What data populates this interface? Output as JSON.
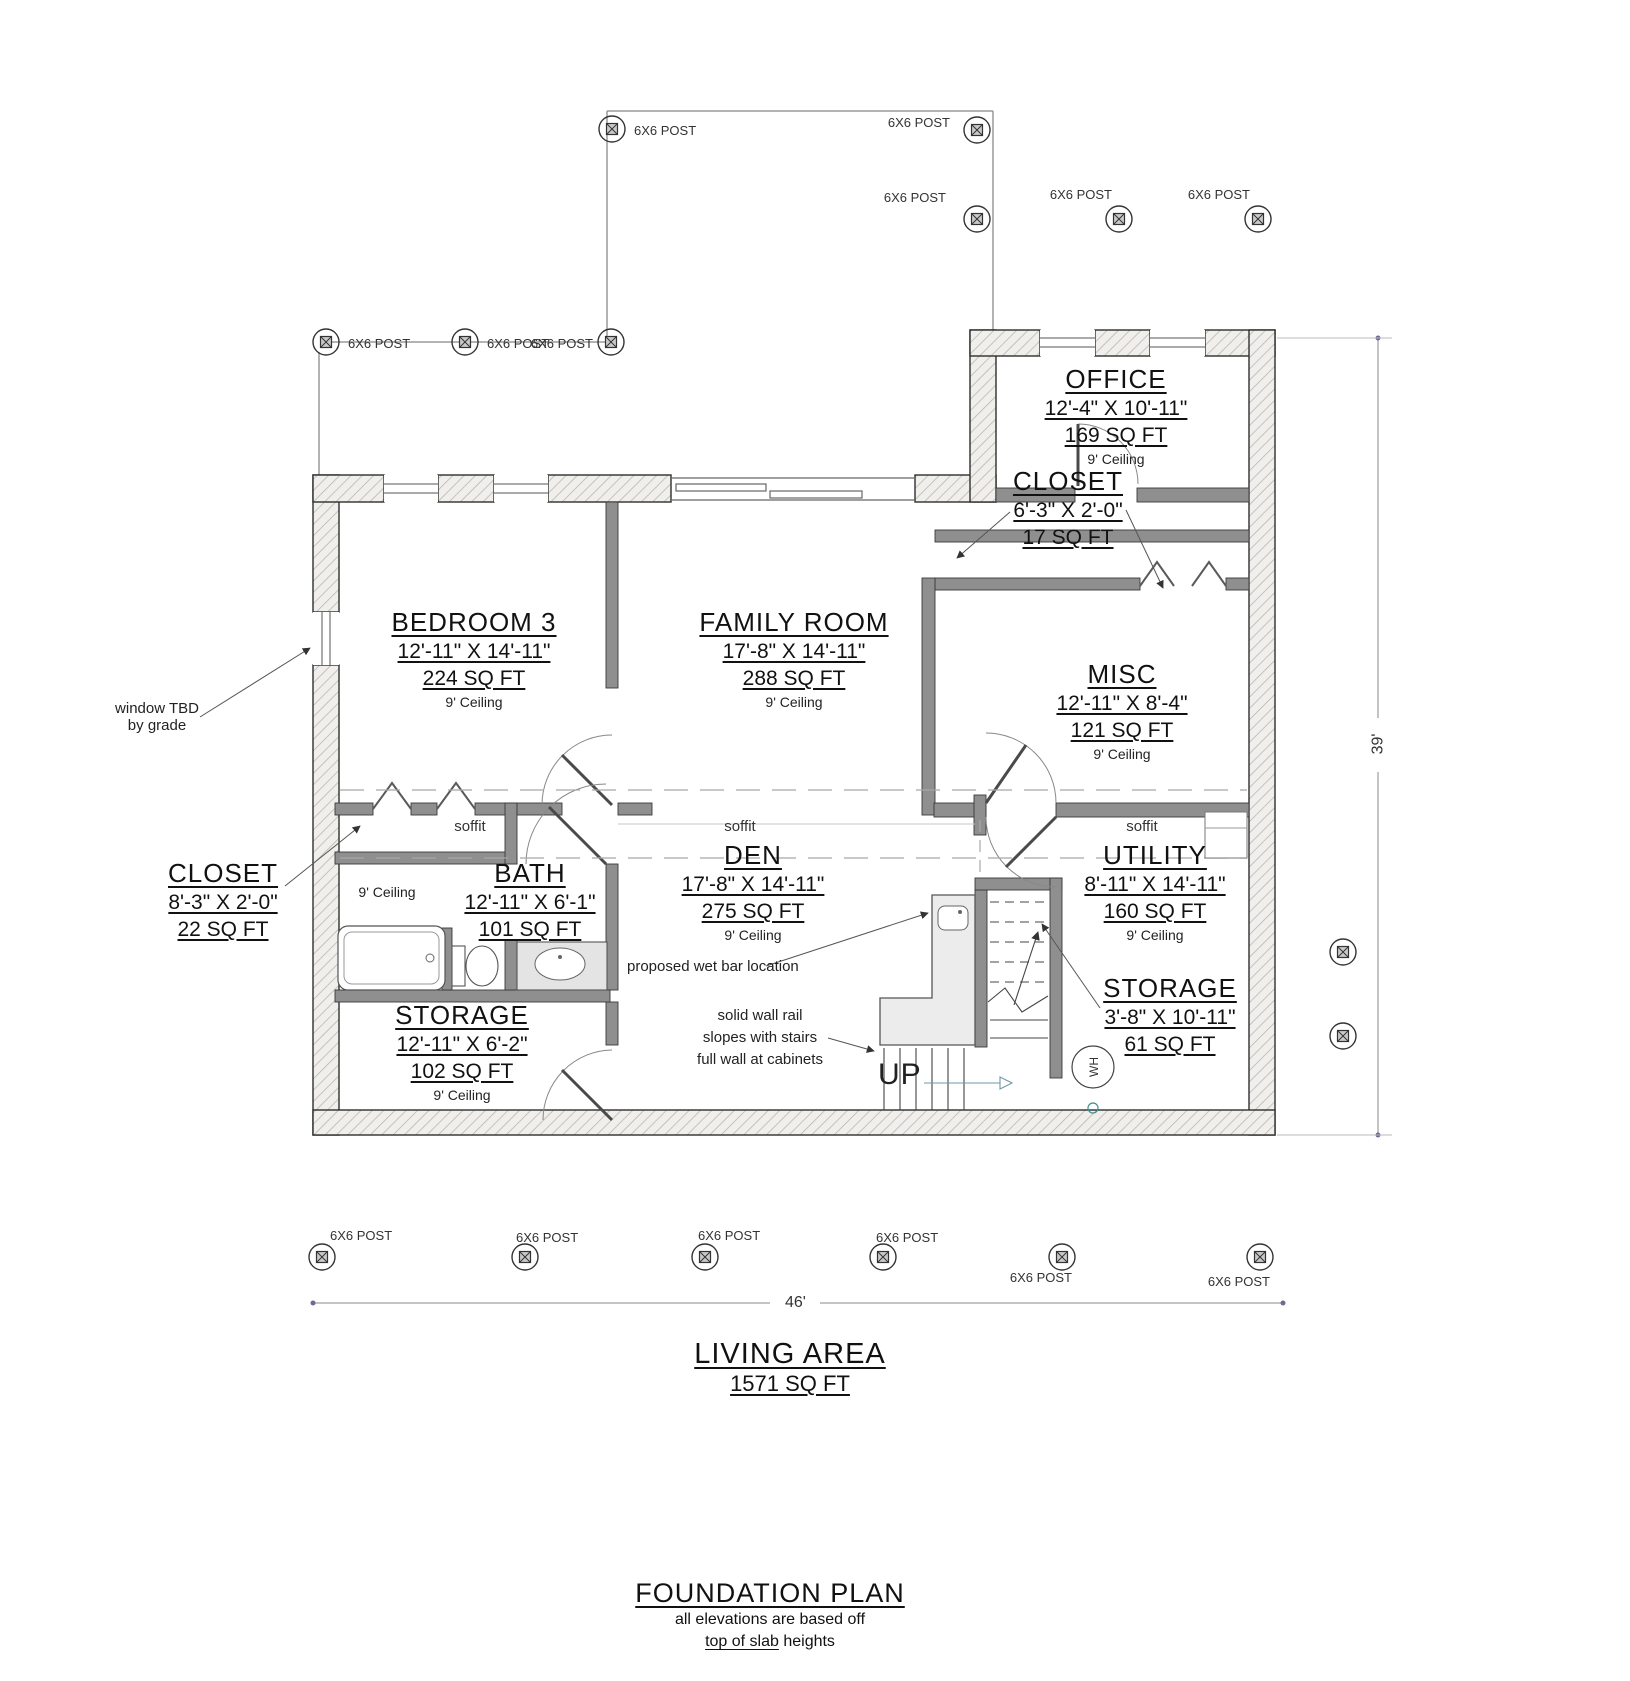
{
  "post_label": "6X6 POST",
  "rooms": [
    {
      "name": "OFFICE",
      "dims": "12'-4\" X 10'-11\"",
      "area": "169 SQ FT",
      "ceiling": "9' Ceiling"
    },
    {
      "name": "CLOSET",
      "dims": "6'-3\" X 2'-0\"",
      "area": "17 SQ FT"
    },
    {
      "name": "MISC",
      "dims": "12'-11\" X 8'-4\"",
      "area": "121 SQ FT",
      "ceiling": "9' Ceiling"
    },
    {
      "name": "BEDROOM 3",
      "dims": "12'-11\" X 14'-11\"",
      "area": "224 SQ FT",
      "ceiling": "9' Ceiling"
    },
    {
      "name": "FAMILY ROOM",
      "dims": "17'-8\" X 14'-11\"",
      "area": "288 SQ FT",
      "ceiling": "9' Ceiling"
    },
    {
      "name": "CLOSET",
      "dims": "8'-3\" X 2'-0\"",
      "area": "22 SQ FT"
    },
    {
      "name": "BATH",
      "dims": "12'-11\" X 6'-1\"",
      "area": "101 SQ FT"
    },
    {
      "name": "DEN",
      "dims": "17'-8\" X 14'-11\"",
      "area": "275 SQ FT",
      "ceiling": "9' Ceiling"
    },
    {
      "name": "UTILITY",
      "dims": "8'-11\" X 14'-11\"",
      "area": "160 SQ FT",
      "ceiling": "9' Ceiling"
    },
    {
      "name": "STORAGE",
      "dims": "3'-8\" X 10'-11\"",
      "area": "61 SQ FT"
    },
    {
      "name": "STORAGE",
      "dims": "12'-11\" X 6'-2\"",
      "area": "102 SQ FT",
      "ceiling": "9' Ceiling"
    }
  ],
  "annotations": {
    "window_note_1": "window TBD",
    "window_note_2": "by grade",
    "ceiling_note": "9' Ceiling",
    "soffit": "soffit",
    "wet_bar_note": "proposed wet bar location",
    "rail_note_1": "solid wall rail",
    "rail_note_2": "slopes with stairs",
    "rail_note_3": "full wall at cabinets",
    "up": "UP",
    "wh": "WH"
  },
  "dimensions": {
    "width": "46'",
    "height": "39'"
  },
  "footer": {
    "living_area_label": "LIVING AREA",
    "living_area_value": "1571 SQ FT",
    "plan_title": "FOUNDATION PLAN",
    "plan_note_1": "all elevations are based off",
    "plan_note_2a": "top of slab",
    "plan_note_2b": " heights"
  },
  "plan": {
    "posts": [
      {
        "x": 612,
        "y": 129,
        "labeled": true,
        "lx": 634,
        "ly": 135,
        "anchor": "start"
      },
      {
        "x": 977,
        "y": 130,
        "labeled": true,
        "lx": 950,
        "ly": 127,
        "anchor": "end"
      },
      {
        "x": 977,
        "y": 219,
        "labeled": true,
        "lx": 946,
        "ly": 202,
        "anchor": "end"
      },
      {
        "x": 1119,
        "y": 219,
        "labeled": true,
        "lx": 1112,
        "ly": 199,
        "anchor": "end"
      },
      {
        "x": 1258,
        "y": 219,
        "labeled": true,
        "lx": 1250,
        "ly": 199,
        "anchor": "end"
      },
      {
        "x": 326,
        "y": 342,
        "labeled": true,
        "lx": 348,
        "ly": 348,
        "anchor": "start"
      },
      {
        "x": 465,
        "y": 342,
        "labeled": true,
        "lx": 487,
        "ly": 348,
        "anchor": "start"
      },
      {
        "x": 611,
        "y": 342,
        "labeled": true,
        "lx": 593,
        "ly": 348,
        "anchor": "end"
      },
      {
        "x": 322,
        "y": 1257,
        "labeled": true,
        "lx": 330,
        "ly": 1240,
        "anchor": "start"
      },
      {
        "x": 525,
        "y": 1257,
        "labeled": true,
        "lx": 516,
        "ly": 1242,
        "anchor": "start"
      },
      {
        "x": 705,
        "y": 1257,
        "labeled": true,
        "lx": 698,
        "ly": 1240,
        "anchor": "start"
      },
      {
        "x": 883,
        "y": 1257,
        "labeled": true,
        "lx": 876,
        "ly": 1242,
        "anchor": "start"
      },
      {
        "x": 1062,
        "y": 1257,
        "labeled": true,
        "lx": 1072,
        "ly": 1282,
        "anchor": "end"
      },
      {
        "x": 1260,
        "y": 1257,
        "labeled": true,
        "lx": 1270,
        "ly": 1286,
        "anchor": "end"
      },
      {
        "x": 1343,
        "y": 952,
        "labeled": false
      },
      {
        "x": 1343,
        "y": 1036,
        "labeled": false
      }
    ]
  }
}
